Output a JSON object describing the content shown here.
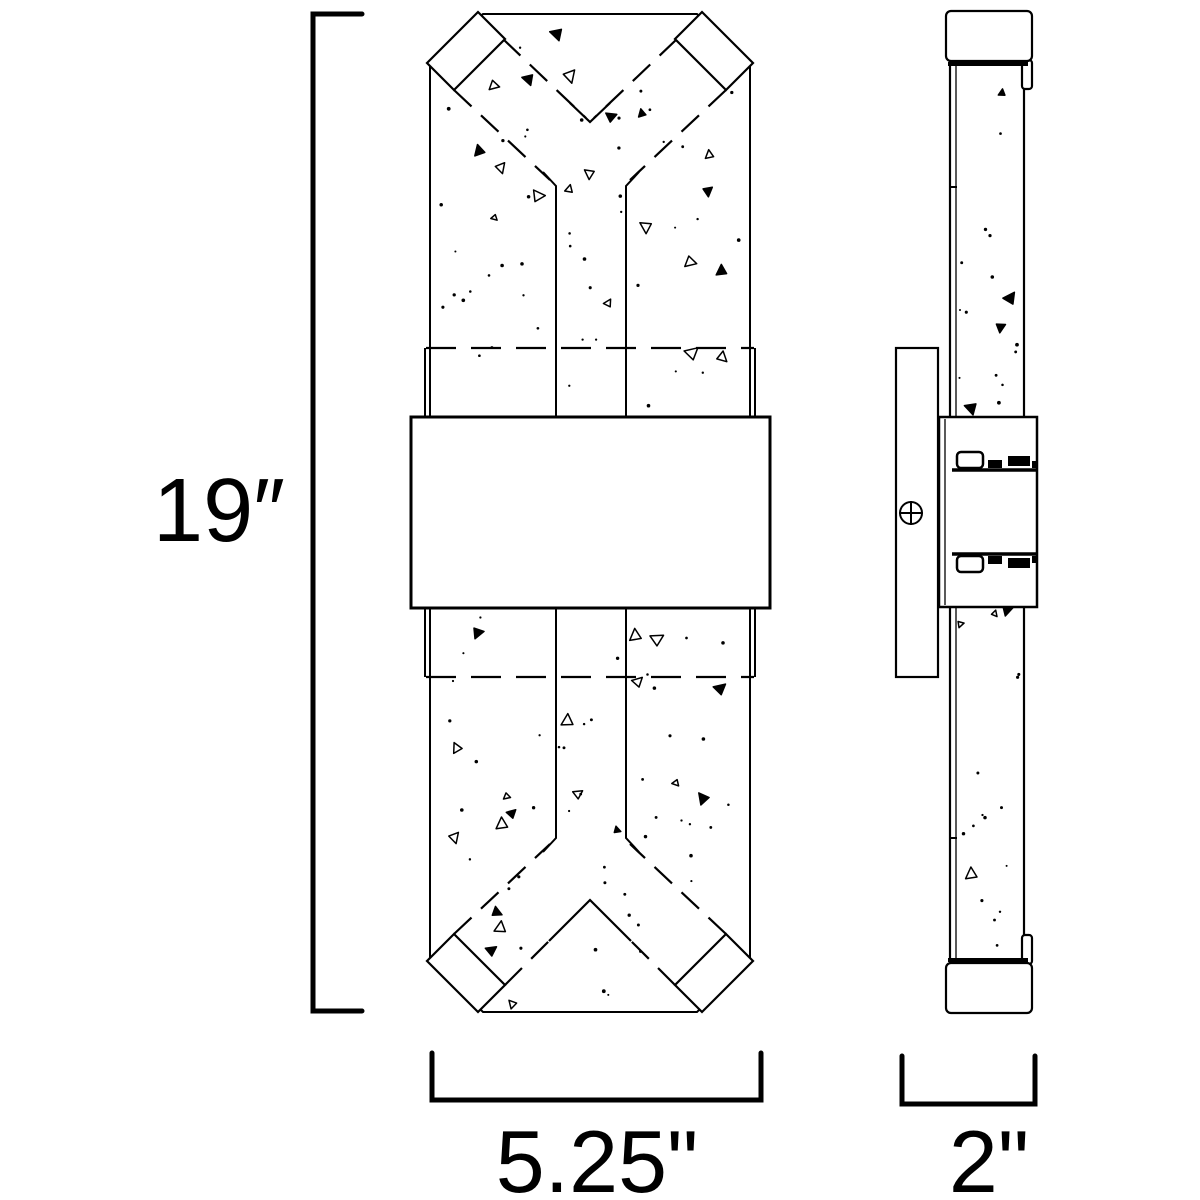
{
  "drawing": {
    "background_color": "#ffffff",
    "line_color": "#000000",
    "dimensions": {
      "height": {
        "label": "19″",
        "value": 19
      },
      "width": {
        "label": "5.25\"",
        "value": 5.25
      },
      "depth": {
        "label": "2\"",
        "value": 2
      }
    }
  }
}
